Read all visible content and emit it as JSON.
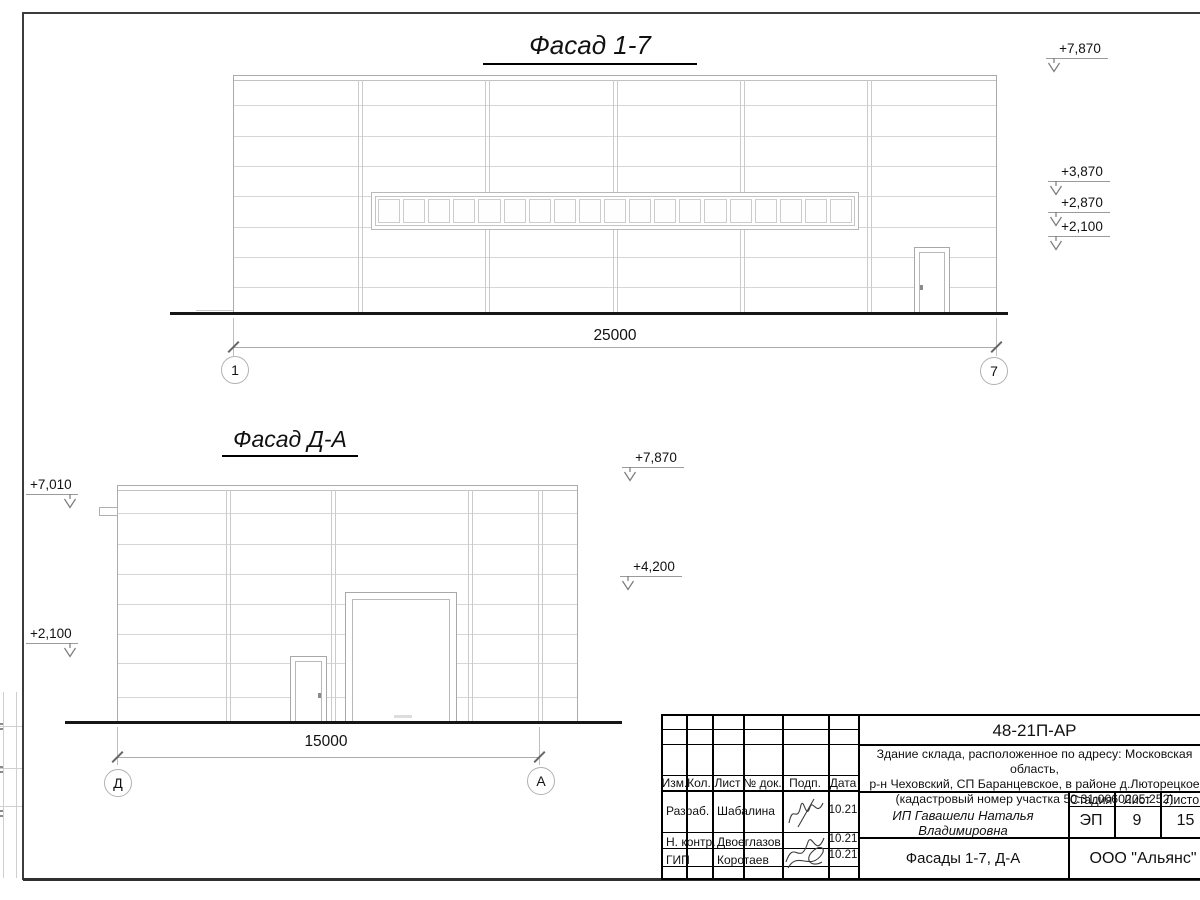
{
  "facade_1_7": {
    "title": "Фасад 1-7",
    "dimension": "25000",
    "axis_left": "1",
    "axis_right": "7",
    "elevations": [
      "+7,870",
      "+3,870",
      "+2,870",
      "+2,100"
    ]
  },
  "facade_d_a": {
    "title": "Фасад Д-А",
    "dimension": "15000",
    "axis_left": "Д",
    "axis_right": "А",
    "elevations_left": [
      "+7,010",
      "+2,100"
    ],
    "elevations_right": [
      "+7,870",
      "+4,200"
    ]
  },
  "title_block": {
    "doc_number": "48-21П-АР",
    "description_line1": "Здание склада, расположенное по адресу: Московская область,",
    "description_line2": "р-н Чеховский, СП Баранцевское, в районе д.Люторецкое",
    "description_line3": "(кадастровый номер участка 50:31:0060205:252)",
    "col_izm": "Изм.",
    "col_kol": "Кол.",
    "col_list": "Лист",
    "col_ndok": "№ док.",
    "col_podp": "Подп.",
    "col_data": "Дата",
    "row1_role": "Разраб.",
    "row1_name": "Шабалина",
    "row1_date": "10.21",
    "row2_role": "Н. контр.",
    "row2_name": "Двоеглазов",
    "row2_date": "10.21",
    "row3_role": "ГИП",
    "row3_name": "Коротаев",
    "row3_date": "10.21",
    "client": "ИП Гавашели Наталья Владимировна",
    "stage_label": "Стадия",
    "list_label": "Лист",
    "listov_label": "Листов",
    "stage": "ЭП",
    "sheet_number": "9",
    "sheets_total": "15",
    "sheet_title": "Фасады 1-7, Д-А",
    "company": "ООО \"Альянс\""
  },
  "colors": {
    "panel_line": "#d6d6d6",
    "outline": "#ababab",
    "ground": "#161616",
    "frame": "#3c3c3c",
    "text": "#111111"
  }
}
